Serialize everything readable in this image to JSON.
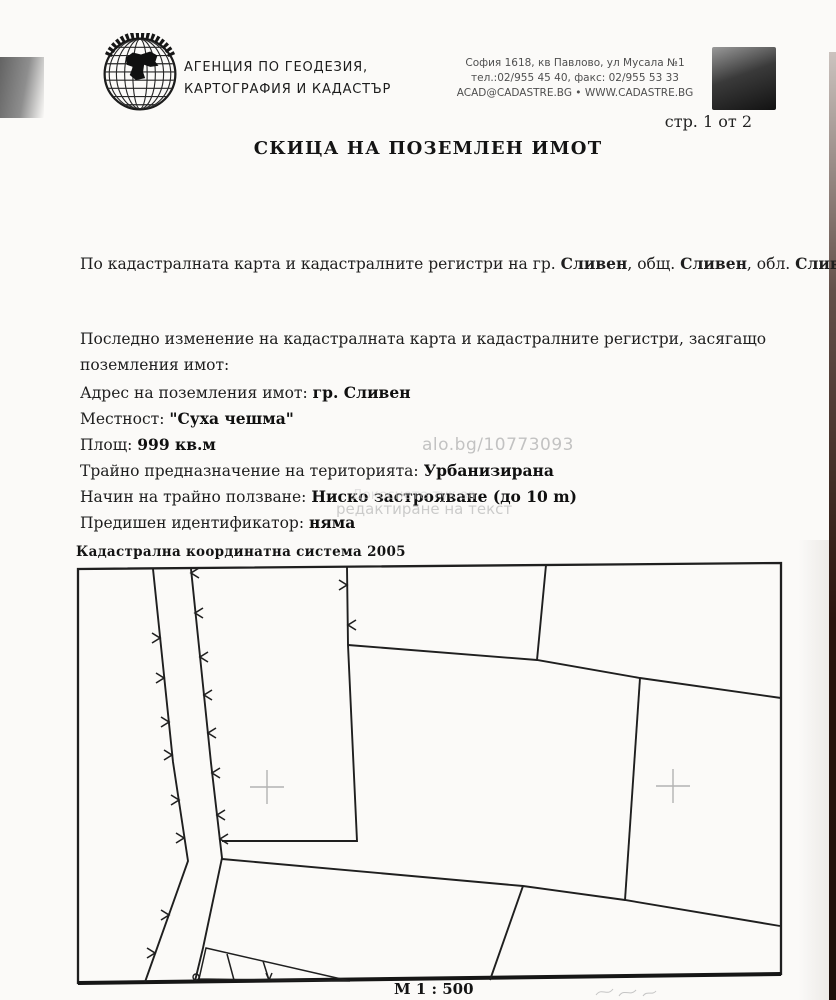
{
  "header": {
    "agency_name_line1": "АГЕНЦИЯ ПО ГЕОДЕЗИЯ,",
    "agency_name_line2": "КАРТОГРАФИЯ И КАДАСТЪР",
    "contact_line1": "София 1618, кв Павлово, ул Мусала №1",
    "contact_line2": "тел.:02/955 45 40, факс: 02/955 53 33",
    "contact_line3": "ACAD@CADASTRE.BG • WWW.CADASTRE.BG",
    "page_indicator": "стр. 1 от 2"
  },
  "title": "СКИЦА НА ПОЗЕМЛЕН ИМОТ",
  "paragraph1": {
    "segments": [
      {
        "text": "По кадастралната карта и кадастралните регистри на гр. "
      },
      {
        "text": "Сливен",
        "bold": true
      },
      {
        "text": ", общ. "
      },
      {
        "text": "Сливен",
        "bold": true
      },
      {
        "text": ", обл. "
      },
      {
        "text": "Сливен,",
        "bold": true
      }
    ]
  },
  "last_amendment": "Последно изменение на кадастралната карта и кадастралните регистри, засягащо поземления имот:",
  "info_rows": [
    {
      "label": "Адрес на поземления имот: ",
      "value": "гр. Сливен"
    },
    {
      "label": "Местност: ",
      "value": "\"Суха чешма\""
    },
    {
      "label": "Площ: ",
      "value": "999 кв.м"
    },
    {
      "label": "Трайно предназначение на територията: ",
      "value": "Урбанизирана"
    },
    {
      "label": "Начин на трайно ползване: ",
      "value": "Ниско застрояване (до 10 m)"
    },
    {
      "label": "Предишен идентификатор: ",
      "value": "няма"
    }
  ],
  "watermark": {
    "line1": "alo.bg/10773093",
    "line2_faint": "Докоснете тук за",
    "line3": "редактиране на текст"
  },
  "map": {
    "coordinate_system_label": "Кадастрална координатна система 2005",
    "scale_label": "М 1 : 500",
    "paths": {
      "border": "M78,569 L781,563 L781,974 L78,983 Z",
      "border_bottom": "M78,983 L781,974",
      "road_left": "M153,569 L173,762 L188,861 L145,982",
      "road_right": "M191,569 L211,763 L222,858 L203,948 L195,981",
      "left_parcel_boundary": "M347,567 L348,645 L357,841 L222,841",
      "upper_boundary": "M348,645 L537,660 L640,678 L781,698",
      "top_divider": "M546,565 L537,660",
      "mid_vertical": "M640,678 L625,900",
      "lower_boundary": "M222,859 L523,886 L625,900 L780,926",
      "branch_line": "M523,886 L490,980",
      "building_strip": "M206,948 L350,981 L199,979 Z M227,954 L234,980 M263,961 L269,980 M266,973 L269,980 L272,973",
      "ticks_left": "M152,633 L160,638 L152,643 M156,673 L164,678 L156,683 M161,717 L169,722 L161,727 M164,750 L172,755 L164,760 M171,795 L179,800 L171,805 M176,833 L184,838 L176,843 M161,910 L169,915 L161,920 M147,948 L155,953 L147,958",
      "ticks_right": "M199,568 L191,573 L199,578 M203,608 L195,613 L203,618 M208,652 L200,657 L208,662 M212,690 L204,695 L212,700 M216,728 L208,733 L216,738 M220,768 L212,773 L220,778 M225,810 L217,815 L225,820 M228,834 L220,839 L228,844",
      "ticks_boundary": "M339,580 L347,585 L339,590 M356,620 L348,625 L356,630",
      "cross_left": "M250,787 L284,787 M267,770 L267,804",
      "cross_right": "M656,786 L690,786 M673,769 L673,803",
      "scribble": "M596,995 C602,987 607,997 613,989 M619,996 C624,988 630,997 636,990 M643,996 C647,990 652,996 656,991"
    }
  },
  "colors": {
    "ink": "#1f1f1f",
    "watermark": "#bdbdbd",
    "grid_cross": "#b2b2b2",
    "scan_edge": "#2a140d"
  }
}
